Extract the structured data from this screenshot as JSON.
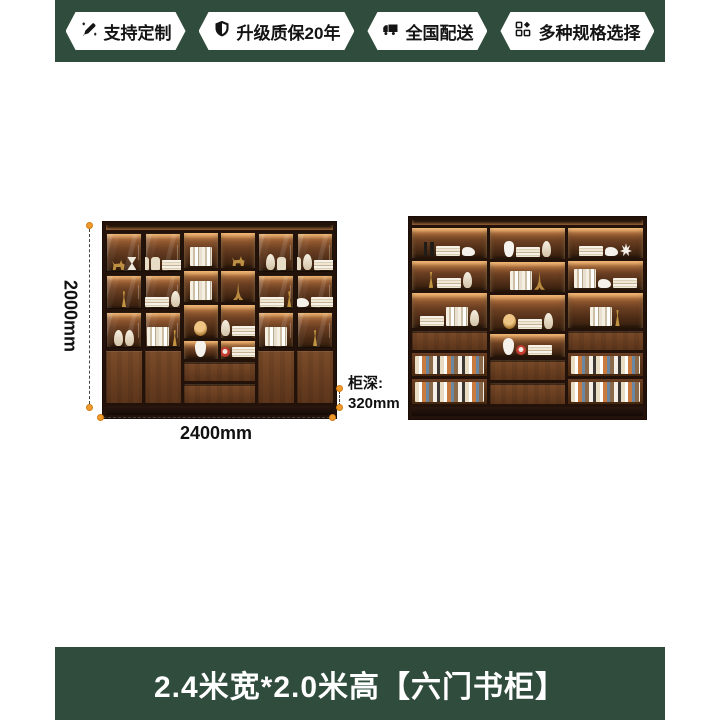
{
  "image": {
    "background": "#ffffff",
    "brand_green": "#2f4c3c",
    "accent_orange": "#f09a2e",
    "wood_dark": "#23120a"
  },
  "header": {
    "badges": [
      {
        "icon": "pencil-icon",
        "label": "支持定制"
      },
      {
        "icon": "shield-icon",
        "label": "升级质保20年"
      },
      {
        "icon": "truck-icon",
        "label": "全国配送"
      },
      {
        "icon": "grid-icon",
        "label": "多种规格选择"
      }
    ]
  },
  "dimensions": {
    "height_label": "2000mm",
    "width_label": "2400mm",
    "depth_line1": "柜深:",
    "depth_line2": "320mm"
  },
  "footer": {
    "title": "2.4米宽*2.0米高【六门书柜】"
  },
  "bookcases": {
    "left": {
      "t": "col",
      "n": "bookcase-closed",
      "c": [
        {
          "t": "toplit",
          "f": 3
        },
        {
          "t": "row",
          "f": 180,
          "c": [
            {
              "t": "col",
              "f": 10,
              "c": [
                {
                  "t": "glass",
                  "f": 46,
                  "items": [
                    "deer",
                    "hourglass"
                  ]
                },
                {
                  "t": "glass",
                  "f": 40,
                  "items": [
                    "trophy"
                  ]
                },
                {
                  "t": "glass",
                  "f": 42,
                  "items": [
                    "vase",
                    "vase"
                  ]
                },
                {
                  "t": "door",
                  "f": 62
                }
              ]
            },
            {
              "t": "col",
              "f": 10,
              "c": [
                {
                  "t": "glass",
                  "f": 46,
                  "items": [
                    "canister",
                    "canister",
                    "hbooks"
                  ]
                },
                {
                  "t": "glass",
                  "f": 40,
                  "items": [
                    "hbooks",
                    "vase"
                  ]
                },
                {
                  "t": "glass",
                  "f": 42,
                  "items": [
                    "vbooks",
                    "trophy"
                  ]
                },
                {
                  "t": "door",
                  "f": 62
                }
              ]
            },
            {
              "t": "col",
              "f": 20,
              "c": [
                {
                  "t": "row",
                  "f": 128,
                  "c": [
                    {
                      "t": "col",
                      "f": 1,
                      "c": [
                        {
                          "t": "shelf",
                          "f": 46,
                          "items": [
                            "vbooks"
                          ]
                        },
                        {
                          "t": "shelf",
                          "f": 40,
                          "items": [
                            "vbooks"
                          ]
                        },
                        {
                          "t": "shelf",
                          "f": 42,
                          "items": [
                            "globe"
                          ]
                        }
                      ]
                    },
                    {
                      "t": "col",
                      "f": 1,
                      "c": [
                        {
                          "t": "shelf",
                          "f": 46,
                          "items": [
                            "deer"
                          ]
                        },
                        {
                          "t": "shelf",
                          "f": 40,
                          "items": [
                            "tower"
                          ]
                        },
                        {
                          "t": "shelf",
                          "f": 42,
                          "items": [
                            "vase",
                            "hbooks"
                          ]
                        }
                      ]
                    }
                  ]
                },
                {
                  "t": "row",
                  "f": 22,
                  "c": [
                    {
                      "t": "shelf",
                      "f": 1,
                      "items": [
                        "doll"
                      ]
                    },
                    {
                      "t": "shelf",
                      "f": 1,
                      "items": [
                        "clock",
                        "hbooks"
                      ]
                    }
                  ]
                },
                {
                  "t": "drawer",
                  "f": 21
                },
                {
                  "t": "drawer",
                  "f": 21
                }
              ]
            },
            {
              "t": "col",
              "f": 10,
              "c": [
                {
                  "t": "glass",
                  "f": 46,
                  "items": [
                    "vase",
                    "canister"
                  ]
                },
                {
                  "t": "glass",
                  "f": 40,
                  "items": [
                    "hbooks",
                    "trophy"
                  ]
                },
                {
                  "t": "glass",
                  "f": 42,
                  "items": [
                    "vbooks"
                  ]
                },
                {
                  "t": "door",
                  "f": 62
                }
              ]
            },
            {
              "t": "col",
              "f": 10,
              "c": [
                {
                  "t": "glass",
                  "f": 46,
                  "items": [
                    "canister",
                    "vase",
                    "hbooks"
                  ]
                },
                {
                  "t": "glass",
                  "f": 40,
                  "items": [
                    "bird",
                    "hbooks"
                  ]
                },
                {
                  "t": "glass",
                  "f": 42,
                  "items": [
                    "trophy"
                  ]
                },
                {
                  "t": "door",
                  "f": 62
                }
              ]
            }
          ]
        },
        {
          "t": "plinth",
          "f": 7
        }
      ]
    },
    "right": {
      "t": "col",
      "n": "bookcase-open",
      "c": [
        {
          "t": "toplit",
          "f": 3
        },
        {
          "t": "row",
          "f": 186,
          "c": [
            {
              "t": "col",
              "f": 1,
              "c": [
                {
                  "t": "shelf",
                  "f": 36,
                  "items": [
                    "candle",
                    "hbooks",
                    "bird"
                  ]
                },
                {
                  "t": "shelf",
                  "f": 34,
                  "items": [
                    "trophy",
                    "hbooks",
                    "vase"
                  ]
                },
                {
                  "t": "shelf",
                  "f": 42,
                  "items": [
                    "hbooks",
                    "vbooks",
                    "vase"
                  ]
                },
                {
                  "t": "drawer",
                  "f": 22
                },
                {
                  "t": "books",
                  "f": 26
                },
                {
                  "t": "books",
                  "f": 30
                }
              ]
            },
            {
              "t": "col",
              "f": 1,
              "c": [
                {
                  "t": "shelf",
                  "f": 36,
                  "items": [
                    "astro",
                    "hbooks",
                    "vase"
                  ]
                },
                {
                  "t": "shelf",
                  "f": 34,
                  "items": [
                    "vbooks",
                    "tower"
                  ]
                },
                {
                  "t": "shelf",
                  "f": 42,
                  "items": [
                    "globe",
                    "hbooks",
                    "vase"
                  ]
                },
                {
                  "t": "shelf",
                  "f": 26,
                  "items": [
                    "doll",
                    "clock",
                    "hbooks"
                  ]
                },
                {
                  "t": "drawer",
                  "f": 22
                },
                {
                  "t": "drawer",
                  "f": 24
                }
              ]
            },
            {
              "t": "col",
              "f": 1,
              "c": [
                {
                  "t": "shelf",
                  "f": 36,
                  "items": [
                    "hbooks",
                    "bird",
                    "coral"
                  ]
                },
                {
                  "t": "shelf",
                  "f": 34,
                  "items": [
                    "vbooks",
                    "bird",
                    "hbooks"
                  ]
                },
                {
                  "t": "shelf",
                  "f": 42,
                  "items": [
                    "vbooks",
                    "trophy"
                  ]
                },
                {
                  "t": "drawer",
                  "f": 22
                },
                {
                  "t": "books",
                  "f": 26
                },
                {
                  "t": "books",
                  "f": 30
                }
              ]
            }
          ]
        },
        {
          "t": "plinth",
          "f": 7
        }
      ]
    }
  }
}
